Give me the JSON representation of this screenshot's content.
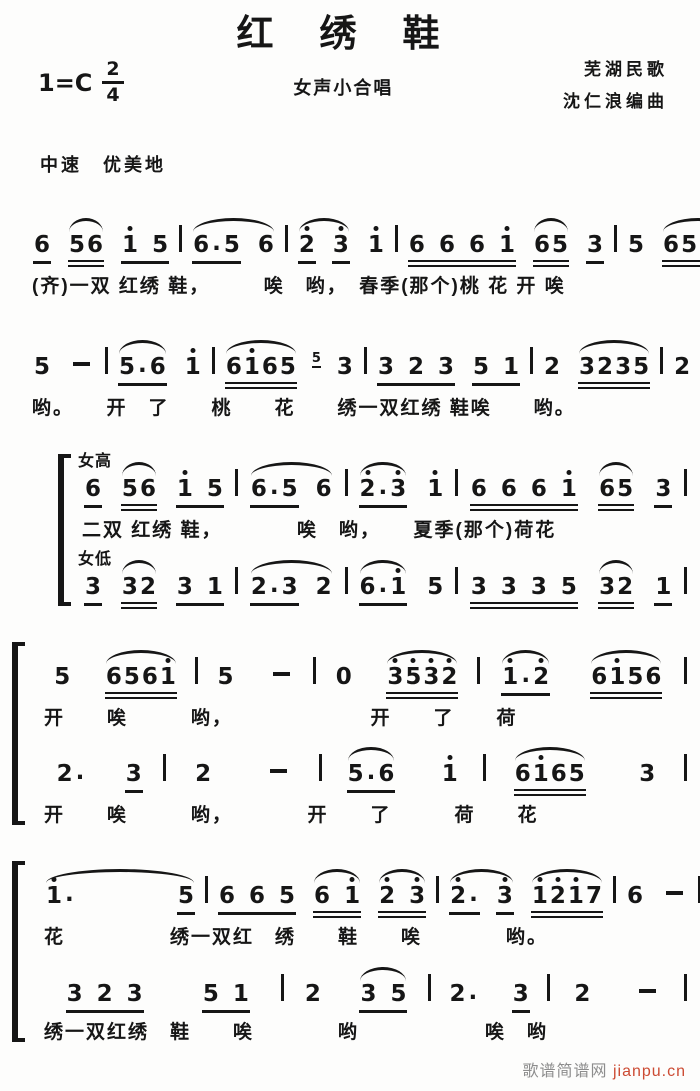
{
  "header": {
    "title": "红绣鞋",
    "key_signature": "1=C",
    "time_numerator": "2",
    "time_denominator": "4",
    "ensemble": "女声小合唱",
    "credit_line1": "芜湖民歌",
    "credit_line2": "沈仁浪编曲",
    "tempo": "中速　优美地"
  },
  "notation_legend": "jianpu numbered notation; apostrophe = octave dot above previous digit; ul = underline beams; slur = arc above; grace = small ornament note",
  "systems": [
    {
      "bracket": false,
      "voices": [
        {
          "label": "",
          "measures": [
            [
              {
                "t": "6",
                "ul": 1
              },
              {
                "t": "56",
                "ul": 2,
                "slur": true
              },
              {
                "t": "1' 5",
                "ul": 1
              }
            ],
            [
              {
                "slur": true,
                "items": [
                  {
                    "t": "6.5",
                    "ul": 1
                  },
                  {
                    "t": "6"
                  }
                ]
              }
            ],
            [
              {
                "slur": true,
                "items": [
                  {
                    "t": "2'",
                    "ul": 1
                  },
                  {
                    "t": "3'",
                    "ul": 1
                  }
                ]
              },
              {
                "t": "1'"
              }
            ],
            [
              {
                "t": "6 6 6 1'",
                "ul": 2
              },
              {
                "t": "65",
                "ul": 2,
                "slur": true
              },
              {
                "t": "3",
                "ul": 1
              }
            ],
            [
              {
                "t": "5"
              },
              {
                "t": "6561'",
                "ul": 2,
                "slur": true
              }
            ]
          ],
          "lyrics": "(齐)一双 红绣 鞋，　　　唉　哟，　春季(那个)桃 花 开 唉"
        }
      ]
    },
    {
      "bracket": false,
      "voices": [
        {
          "label": "",
          "measures": [
            [
              {
                "t": "5"
              },
              {
                "t": "-"
              }
            ],
            [
              {
                "t": "5.6",
                "ul": 1,
                "slur": true
              },
              {
                "t": "1'"
              }
            ],
            [
              {
                "t": "61'65",
                "ul": 2,
                "slur": true
              },
              {
                "t": "5",
                "grace": true
              },
              {
                "t": "3"
              }
            ],
            [
              {
                "t": "3 2 3",
                "ul": 1
              },
              {
                "t": "5 1",
                "ul": 1
              }
            ],
            [
              {
                "t": "2"
              },
              {
                "t": "3235",
                "ul": 2,
                "slur": true
              }
            ],
            [
              {
                "t": "2"
              },
              {
                "t": "-"
              }
            ]
          ],
          "lyrics": "哟。　　开　了　　桃　　花　　绣一双红绣 鞋唉　　哟。"
        }
      ]
    },
    {
      "bracket": true,
      "voices": [
        {
          "label": "女高",
          "measures": [
            [
              {
                "t": "6",
                "ul": 1
              },
              {
                "t": "56",
                "ul": 2,
                "slur": true
              },
              {
                "t": "1' 5",
                "ul": 1
              }
            ],
            [
              {
                "slur": true,
                "items": [
                  {
                    "t": "6.5",
                    "ul": 1
                  },
                  {
                    "t": "6"
                  }
                ]
              }
            ],
            [
              {
                "t": "2'.3'",
                "ul": 1,
                "slur": true
              },
              {
                "t": "1'"
              }
            ],
            [
              {
                "t": "6 6 6 1'",
                "ul": 2
              },
              {
                "t": "65",
                "ul": 2,
                "slur": true
              },
              {
                "t": "3",
                "ul": 1
              }
            ]
          ],
          "lyrics": "二双 红绣 鞋，　　　　唉　哟，　　夏季(那个)荷花"
        },
        {
          "label": "女低",
          "measures": [
            [
              {
                "t": "3",
                "ul": 1
              },
              {
                "t": "32",
                "ul": 2,
                "slur": true
              },
              {
                "t": "3 1",
                "ul": 1
              }
            ],
            [
              {
                "slur": true,
                "items": [
                  {
                    "t": "2.3",
                    "ul": 1
                  },
                  {
                    "t": "2"
                  }
                ]
              }
            ],
            [
              {
                "t": "6.1'",
                "ul": 1,
                "slur": true
              },
              {
                "t": "5"
              }
            ],
            [
              {
                "t": "3 3 3 5",
                "ul": 2
              },
              {
                "t": "32",
                "ul": 2,
                "slur": true
              },
              {
                "t": "1",
                "ul": 1
              }
            ]
          ],
          "lyrics": ""
        }
      ]
    },
    {
      "bracket": true,
      "voices": [
        {
          "label": "",
          "measures": [
            [
              {
                "t": "5"
              },
              {
                "t": "6561'",
                "ul": 2,
                "slur": true
              }
            ],
            [
              {
                "t": "5"
              },
              {
                "t": "-"
              }
            ],
            [
              {
                "t": "0"
              },
              {
                "t": "3'5'3'2'",
                "ul": 2,
                "slur": true
              }
            ],
            [
              {
                "t": "1'.2'",
                "ul": 1,
                "slur": true
              },
              {
                "t": "61'56",
                "ul": 2,
                "slur": true
              }
            ]
          ],
          "lyrics": "开　　唉　　　哟，　　　　　　　开　　了　　荷"
        },
        {
          "label": "",
          "measures": [
            [
              {
                "t": "2."
              },
              {
                "t": "3",
                "ul": 1
              }
            ],
            [
              {
                "t": "2"
              },
              {
                "t": "-"
              }
            ],
            [
              {
                "t": "5.6",
                "ul": 1,
                "slur": true
              },
              {
                "t": "1'"
              }
            ],
            [
              {
                "t": "61'65",
                "ul": 2,
                "slur": true
              },
              {
                "t": "3"
              }
            ]
          ],
          "lyrics": "开　　唉　　　哟，　　　　开　　了　　　荷　　花"
        }
      ]
    },
    {
      "bracket": true,
      "voices": [
        {
          "label": "",
          "measures": [
            [
              {
                "slur": true,
                "w": 150,
                "items": [
                  {
                    "t": "1'."
                  },
                  {
                    "t": "5",
                    "ul": 1
                  }
                ]
              }
            ],
            [
              {
                "t": "6 6 5",
                "ul": 1
              },
              {
                "t": "6 1'",
                "ul": 2,
                "slur": true
              },
              {
                "t": "2' 3'",
                "ul": 2,
                "slur": true
              }
            ],
            [
              {
                "slur": true,
                "items": [
                  {
                    "t": "2'.",
                    "ul": 1
                  },
                  {
                    "t": "3'",
                    "ul": 1
                  }
                ]
              },
              {
                "t": "1'2'1'7",
                "ul": 2,
                "slur": true
              }
            ],
            [
              {
                "t": "6"
              },
              {
                "t": "-"
              }
            ]
          ],
          "lyrics": "花　　　　　绣一双红　绣　　鞋　　唉　　　　哟。"
        },
        {
          "label": "",
          "measures": [
            [
              {
                "t": "3 2 3",
                "ul": 1
              },
              {
                "t": "5 1",
                "ul": 1
              }
            ],
            [
              {
                "t": "2"
              },
              {
                "t": "3 5",
                "ul": 1,
                "slur": true
              }
            ],
            [
              {
                "t": "2."
              },
              {
                "t": "3",
                "ul": 1
              }
            ],
            [
              {
                "t": "2"
              },
              {
                "t": "-"
              }
            ]
          ],
          "lyrics": "绣一双红绣　鞋　　唉　　　　哟　　　　　　唉　哟"
        }
      ]
    }
  ],
  "watermark": {
    "site_name": "歌谱简谱网",
    "site_url": "jianpu.cn",
    "site_name_color": "#8d8d8d",
    "url_color": "#cc4b33"
  }
}
